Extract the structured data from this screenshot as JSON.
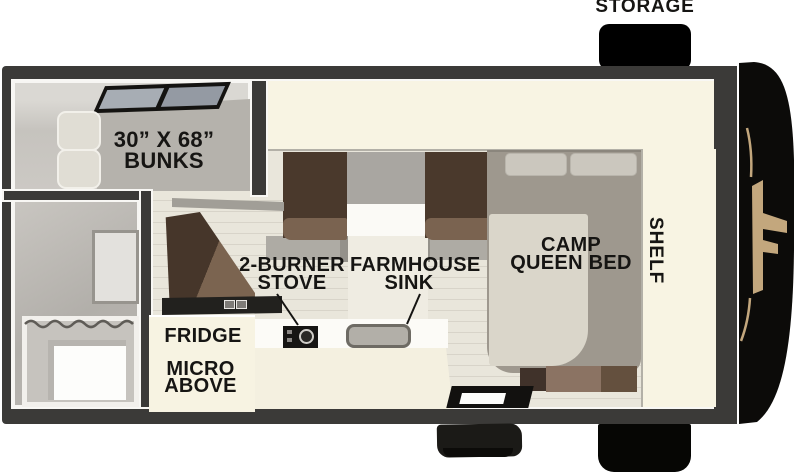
{
  "title": "Truck camper floor plan",
  "labels": {
    "storage": "STORAGE",
    "bunks_line1": "30” X 68”",
    "bunks_line2": "BUNKS",
    "stove_line1": "2-BURNER",
    "stove_line2": "STOVE",
    "sink_line1": "FARMHOUSE",
    "sink_line2": "SINK",
    "fridge": "FRIDGE",
    "micro_line1": "MICRO",
    "micro_line2": "ABOVE",
    "bed_line1": "CAMP",
    "bed_line2": "QUEEN BED",
    "shelf": "SHELF"
  },
  "rooms": [
    {
      "name": "bunk-room",
      "label": "30” X 68” BUNKS"
    },
    {
      "name": "bathroom",
      "label": ""
    },
    {
      "name": "kitchen",
      "labels": [
        "2-BURNER STOVE",
        "FARMHOUSE SINK",
        "FRIDGE",
        "MICRO ABOVE"
      ]
    },
    {
      "name": "bedroom",
      "labels": [
        "CAMP QUEEN BED",
        "SHELF"
      ]
    },
    {
      "name": "exterior",
      "labels": [
        "STORAGE"
      ]
    }
  ],
  "colors": {
    "wall_dark": "#3b3a38",
    "interior_cream": "#f8f4e3",
    "floor_plank": "#e9e6db",
    "seat_brown": "#4a392c",
    "bed_gray": "#9e988e",
    "front_cap_black": "#0c0b09",
    "brand_gold": "#c3a77d",
    "label_text": "#161513"
  }
}
